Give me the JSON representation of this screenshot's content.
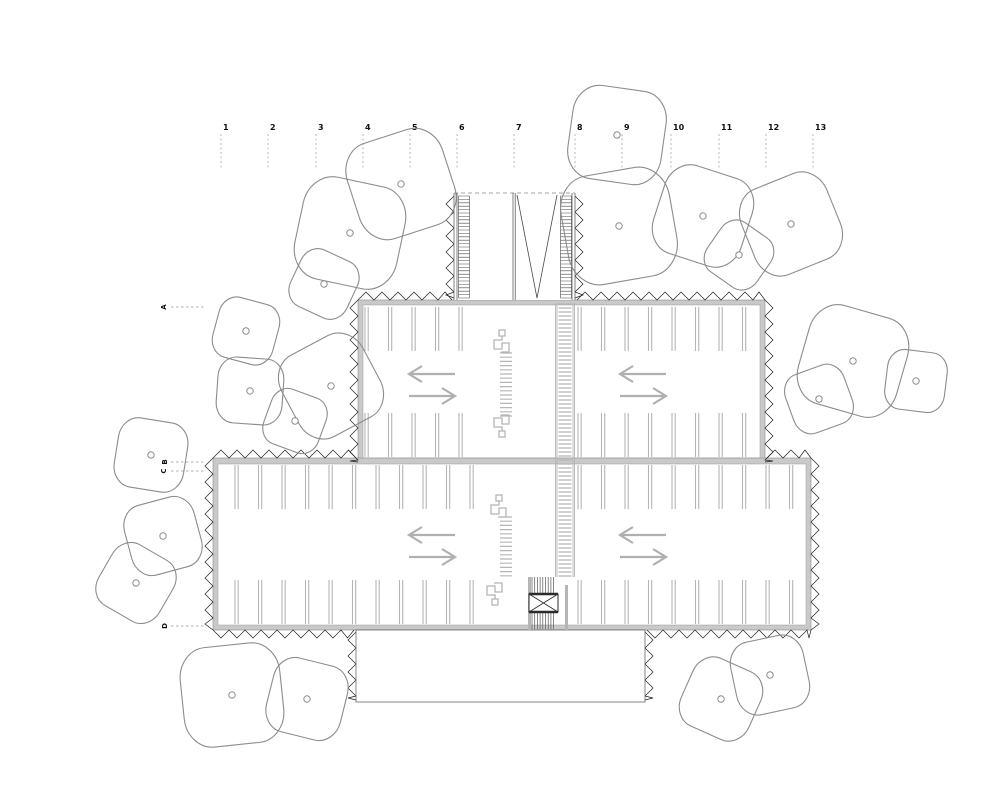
{
  "plan_title": "parking-structure-floor-plan",
  "colors": {
    "wall_fill": "#c9c9c9",
    "wall_edge": "#8a8a8a",
    "inner_edge": "#9a9a9a",
    "teeth": "#1f1f1f",
    "gray_line": "#b5b5b5",
    "arrow": "#b0b0b0",
    "dark_line": "#4a4a4a",
    "core_dark": "#2b2b2b",
    "tree": "#8c8c8c",
    "grid_dash": "#999999",
    "label_text": "#111111"
  },
  "grid": {
    "labels": [
      "1",
      "2",
      "3",
      "4",
      "5",
      "6",
      "7",
      "8",
      "9",
      "10",
      "11",
      "12",
      "13"
    ],
    "xs": [
      221,
      268,
      316,
      363,
      410,
      457,
      514,
      575,
      622,
      671,
      719,
      766,
      813
    ],
    "label_y": 130,
    "dash_y1": 134,
    "dash_y2": 170
  },
  "row_markers": {
    "dash_x1": 171,
    "dash_x2": 205,
    "items": [
      {
        "label": "A",
        "x": 164,
        "y": 307
      },
      {
        "label": "B",
        "x": 165,
        "y": 462
      },
      {
        "label": "C",
        "x": 164,
        "y": 471
      },
      {
        "label": "D",
        "x": 165,
        "y": 626
      }
    ]
  },
  "building": {
    "wings": [
      {
        "name": "upper-wing",
        "outer": [
          358,
          300,
          765,
          462
        ],
        "inner": [
          363,
          305,
          760,
          458
        ]
      },
      {
        "name": "lower-wing",
        "outer": [
          213,
          458,
          811,
          630
        ],
        "inner": [
          218,
          464,
          806,
          625
        ]
      }
    ],
    "teeth_segments": [
      [
        358,
        300,
        452,
        300,
        "up"
      ],
      [
        577,
        300,
        765,
        300,
        "up"
      ],
      [
        358,
        300,
        358,
        462,
        "left"
      ],
      [
        765,
        300,
        765,
        462,
        "right"
      ],
      [
        213,
        458,
        356,
        458,
        "up"
      ],
      [
        767,
        458,
        811,
        458,
        "up"
      ],
      [
        213,
        458,
        213,
        630,
        "left"
      ],
      [
        811,
        458,
        811,
        630,
        "right"
      ],
      [
        213,
        630,
        354,
        630,
        "down"
      ],
      [
        647,
        630,
        811,
        630,
        "down"
      ],
      [
        454,
        196,
        454,
        298,
        "left"
      ],
      [
        575,
        196,
        575,
        298,
        "right"
      ],
      [
        356,
        632,
        356,
        700,
        "left"
      ],
      [
        645,
        632,
        645,
        700,
        "right"
      ]
    ],
    "top_ramp": {
      "x1": 454,
      "y1": 193,
      "x2": 575,
      "y2": 300,
      "wall_x": 513,
      "v_left_x": 517,
      "v_right_x": 557,
      "v_apex": [
        537,
        298
      ],
      "stair_rails": [
        [
          458.5,
          469.5
        ],
        [
          560.5,
          571.5
        ]
      ],
      "tread_step": 3.4
    },
    "bottom_apron": [
      356,
      630,
      645,
      702
    ],
    "core": {
      "left_bar": [
        528,
        577,
        3,
        53
      ],
      "right_bar": [
        565,
        585,
        3,
        45
      ],
      "tread_zones": [
        [
          532,
          556,
          577,
          594
        ],
        [
          532,
          556,
          612,
          629
        ]
      ],
      "tread_step": 2.7,
      "elevator": [
        529,
        594,
        558,
        612
      ]
    }
  },
  "parking": {
    "stall_len": 44,
    "stall_step": 23.5,
    "divider_gap": 3.2,
    "rows": [
      {
        "y": 307,
        "dir": 1,
        "segments": [
          [
            365,
            482
          ],
          [
            578,
            758
          ]
        ]
      },
      {
        "y": 457,
        "dir": -1,
        "segments": [
          [
            365,
            482
          ],
          [
            578,
            758
          ]
        ]
      },
      {
        "y": 465,
        "dir": 1,
        "segments": [
          [
            235,
            482
          ],
          [
            578,
            804
          ]
        ]
      },
      {
        "y": 624,
        "dir": -1,
        "segments": [
          [
            235,
            482
          ],
          [
            578,
            804
          ]
        ]
      }
    ],
    "crosswalks": [
      {
        "x": 500,
        "w": 12,
        "y1": 353,
        "y2": 419,
        "step": 4.2
      },
      {
        "x": 500,
        "w": 12,
        "y1": 517,
        "y2": 577,
        "step": 4.2
      }
    ],
    "ramp_band": {
      "x1": 557,
      "x2": 573,
      "y1": 304,
      "y2": 577,
      "step": 4
    },
    "meanders": [
      [
        497,
        330,
        1
      ],
      [
        497,
        437,
        -1
      ],
      [
        494,
        495,
        1
      ],
      [
        490,
        605,
        -1
      ]
    ],
    "arrows": {
      "length": 46,
      "head": 13,
      "gap": 11,
      "centers": [
        [
          432,
          385
        ],
        [
          643,
          385
        ],
        [
          432,
          546
        ],
        [
          643,
          546
        ]
      ]
    }
  },
  "trees": {
    "dot_r": 3.2,
    "items": [
      [
        350,
        233,
        52,
        12
      ],
      [
        401,
        184,
        50,
        -18
      ],
      [
        324,
        284,
        31,
        25
      ],
      [
        617,
        135,
        47,
        8
      ],
      [
        619,
        226,
        55,
        -10
      ],
      [
        703,
        216,
        46,
        18
      ],
      [
        739,
        255,
        30,
        35
      ],
      [
        791,
        224,
        46,
        -22
      ],
      [
        246,
        331,
        31,
        15
      ],
      [
        250,
        391,
        33,
        4
      ],
      [
        331,
        386,
        46,
        -28
      ],
      [
        295,
        421,
        29,
        20
      ],
      [
        151,
        455,
        35,
        9
      ],
      [
        163,
        536,
        36,
        -15
      ],
      [
        136,
        583,
        35,
        30
      ],
      [
        232,
        695,
        50,
        -6
      ],
      [
        307,
        699,
        38,
        14
      ],
      [
        721,
        699,
        37,
        24
      ],
      [
        770,
        675,
        37,
        -12
      ],
      [
        853,
        361,
        51,
        16
      ],
      [
        819,
        399,
        31,
        -20
      ],
      [
        916,
        381,
        30,
        7
      ]
    ]
  }
}
